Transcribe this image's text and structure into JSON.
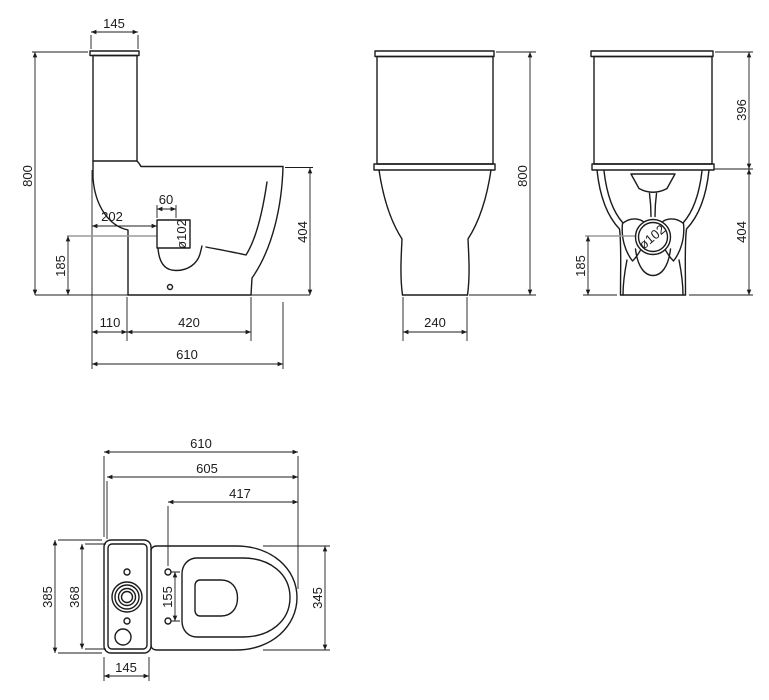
{
  "drawing": {
    "type": "technical-dimension-drawing",
    "subject": "close-coupled toilet with cistern, four orthographic views",
    "units": "mm",
    "colors": {
      "line": "#1c1c1c",
      "centerline": "#9b9b9b",
      "background": "#ffffff"
    },
    "views": {
      "side": {
        "name": "side view",
        "dims": {
          "cistern_top_depth": "145",
          "overall_height": "800",
          "outlet_setback": "202",
          "inlet_width": "60",
          "outlet_diameter": "ø102",
          "outlet_center_height": "185",
          "pan_height": "404",
          "wall_to_foot": "110",
          "foot_length": "420",
          "overall_depth": "610"
        }
      },
      "front": {
        "name": "front view",
        "dims": {
          "overall_height": "800",
          "foot_width": "240"
        }
      },
      "rear": {
        "name": "rear view",
        "dims": {
          "cistern_height": "396",
          "pan_height": "404",
          "outlet_center_height": "185",
          "outlet_diameter": "ø102"
        }
      },
      "top": {
        "name": "top view",
        "dims": {
          "overall_depth": "610",
          "pan_depth": "605",
          "hinge_to_front": "417",
          "cistern_lid_width": "385",
          "cistern_width": "368",
          "hinge_hole_spacing": "155",
          "pan_width": "345",
          "cistern_depth": "145"
        }
      }
    }
  }
}
